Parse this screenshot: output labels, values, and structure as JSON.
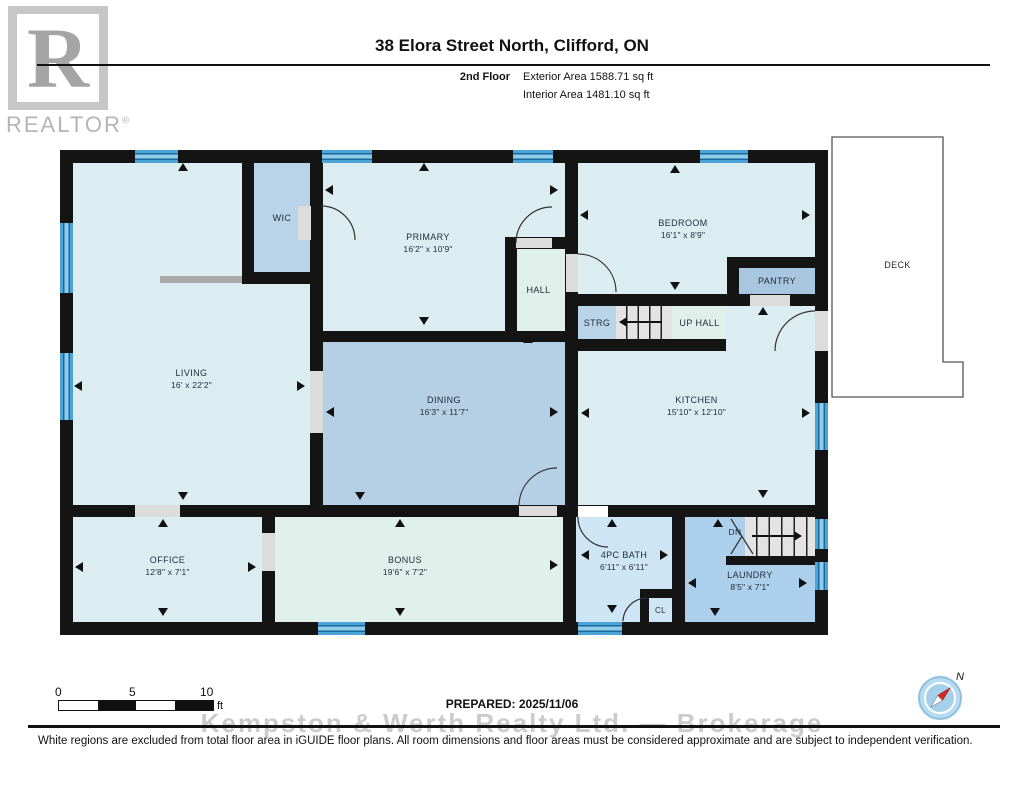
{
  "header": {
    "title": "38 Elora Street North, Clifford, ON",
    "floor_label": "2nd Floor",
    "exterior_area": "Exterior Area 1588.71 sq ft",
    "interior_area": "Interior Area 1481.10 sq ft"
  },
  "logo": {
    "letter": "R",
    "wordmark": "REALTOR",
    "registered": "®"
  },
  "rooms": {
    "living": {
      "name": "LIVING",
      "dims": "16' x 22'2\""
    },
    "wic": {
      "name": "WIC"
    },
    "primary": {
      "name": "PRIMARY",
      "dims": "16'2\" x 10'9\""
    },
    "hall": {
      "name": "HALL"
    },
    "bedroom": {
      "name": "BEDROOM",
      "dims": "16'1\" x 8'9\""
    },
    "pantry": {
      "name": "PANTRY"
    },
    "strg": {
      "name": "STRG"
    },
    "up_hall": {
      "name": "UP HALL"
    },
    "kitchen": {
      "name": "KITCHEN",
      "dims": "15'10\" x 12'10\""
    },
    "dining": {
      "name": "DINING",
      "dims": "16'3\" x 11'7\""
    },
    "office": {
      "name": "OFFICE",
      "dims": "12'8\" x 7'1\""
    },
    "bonus": {
      "name": "BONUS",
      "dims": "19'6\" x 7'2\""
    },
    "bath": {
      "name": "4PC BATH",
      "dims": "6'11\" x 6'11\""
    },
    "closet": {
      "name": "CL"
    },
    "laundry": {
      "name": "LAUNDRY",
      "dims": "8'5\" x 7'1\""
    },
    "stairs_down": {
      "name": "DN"
    },
    "deck": {
      "name": "DECK"
    }
  },
  "scale_bar": {
    "tick_0": "0",
    "tick_5": "5",
    "tick_10": "10",
    "unit": "ft"
  },
  "prepared": "PREPARED: 2025/11/06",
  "watermark": "Kempston & Werth Realty Ltd. — Brokerage",
  "compass": {
    "north_label": "N"
  },
  "disclaimer": "White regions are excluded from total floor area in iGUIDE floor plans. All room dimensions and floor areas must be considered approximate and are subject to independent verification.",
  "colors": {
    "wall": "#141414",
    "pale_room": "#dcedf2",
    "mint_room": "#dff0ea",
    "medium_room": "#b5cfe5",
    "window_blue": "#4ba3d7",
    "accent_red": "#d22a22"
  }
}
